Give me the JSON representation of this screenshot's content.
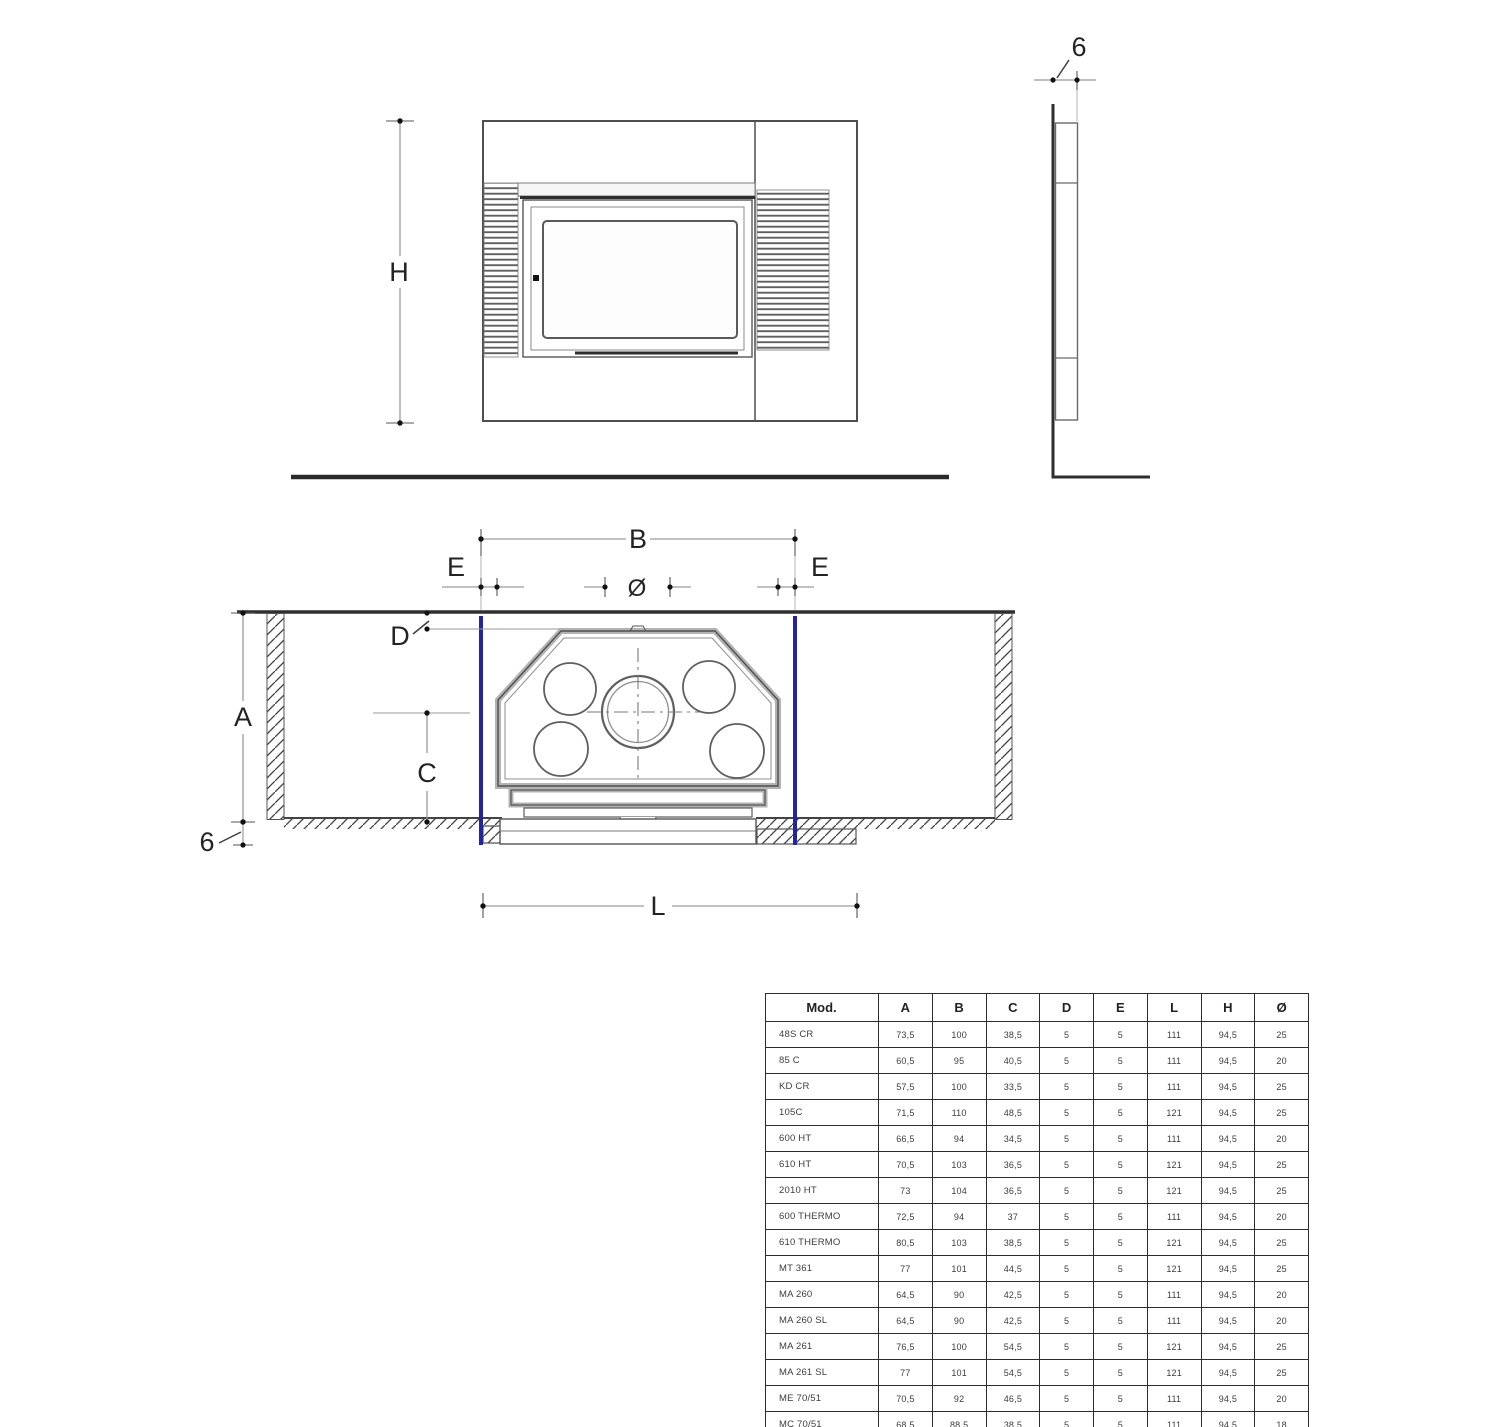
{
  "drawing": {
    "accent_blue": "#24249b",
    "front_view": {
      "height_label": "H"
    },
    "side_view": {
      "thickness_label": "6"
    },
    "plan_view": {
      "width_label": "B",
      "gap_left_label": "E",
      "gap_right_label": "E",
      "flue_diameter_label": "Ø",
      "back_gap_label": "D",
      "depth_label": "A",
      "center_height_label": "C",
      "floor_thickness_label": "6",
      "base_length_label": "L"
    }
  },
  "table": {
    "headers": [
      "Mod.",
      "A",
      "B",
      "C",
      "D",
      "E",
      "L",
      "H",
      "Ø"
    ],
    "rows": [
      [
        "48S CR",
        "73,5",
        "100",
        "38,5",
        "5",
        "5",
        "111",
        "94,5",
        "25"
      ],
      [
        "85 C",
        "60,5",
        "95",
        "40,5",
        "5",
        "5",
        "111",
        "94,5",
        "20"
      ],
      [
        "KD CR",
        "57,5",
        "100",
        "33,5",
        "5",
        "5",
        "111",
        "94,5",
        "25"
      ],
      [
        "105C",
        "71,5",
        "110",
        "48,5",
        "5",
        "5",
        "121",
        "94,5",
        "25"
      ],
      [
        "600 HT",
        "66,5",
        "94",
        "34,5",
        "5",
        "5",
        "111",
        "94,5",
        "20"
      ],
      [
        "610 HT",
        "70,5",
        "103",
        "36,5",
        "5",
        "5",
        "121",
        "94,5",
        "25"
      ],
      [
        "2010 HT",
        "73",
        "104",
        "36,5",
        "5",
        "5",
        "121",
        "94,5",
        "25"
      ],
      [
        "600 THERMO",
        "72,5",
        "94",
        "37",
        "5",
        "5",
        "111",
        "94,5",
        "20"
      ],
      [
        "610 THERMO",
        "80,5",
        "103",
        "38,5",
        "5",
        "5",
        "121",
        "94,5",
        "25"
      ],
      [
        "MT 361",
        "77",
        "101",
        "44,5",
        "5",
        "5",
        "121",
        "94,5",
        "25"
      ],
      [
        "MA 260",
        "64,5",
        "90",
        "42,5",
        "5",
        "5",
        "111",
        "94,5",
        "20"
      ],
      [
        "MA 260 SL",
        "64,5",
        "90",
        "42,5",
        "5",
        "5",
        "111",
        "94,5",
        "20"
      ],
      [
        "MA 261",
        "76,5",
        "100",
        "54,5",
        "5",
        "5",
        "121",
        "94,5",
        "25"
      ],
      [
        "MA 261 SL",
        "77",
        "101",
        "54,5",
        "5",
        "5",
        "121",
        "94,5",
        "25"
      ],
      [
        "ME 70/51",
        "70,5",
        "92",
        "46,5",
        "5",
        "5",
        "111",
        "94,5",
        "20"
      ],
      [
        "MC 70/51",
        "68,5",
        "88,5",
        "38,5",
        "5",
        "5",
        "111",
        "94,5",
        "18"
      ]
    ]
  }
}
